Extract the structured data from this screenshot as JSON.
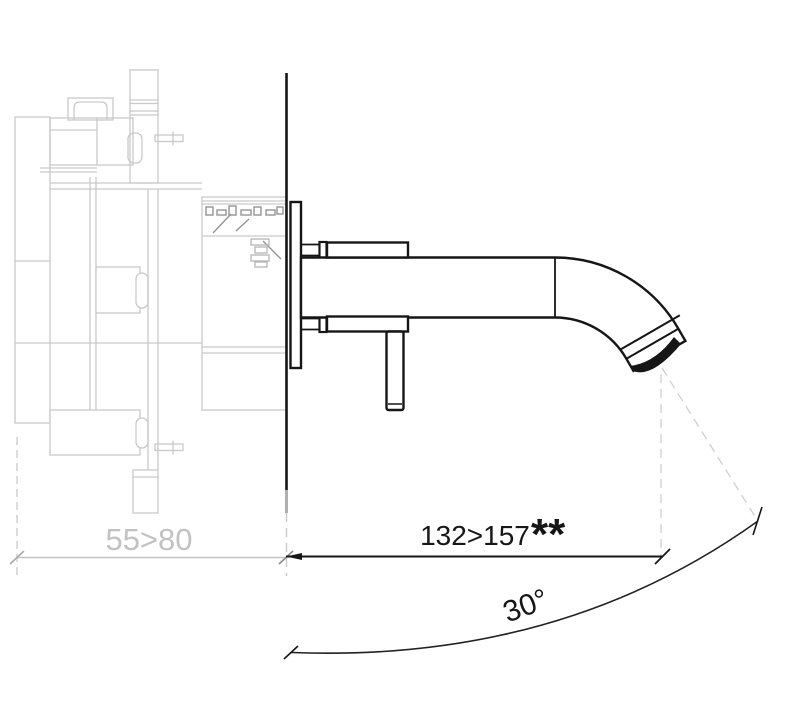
{
  "drawing": {
    "dimensions": {
      "depth_label": "55>80",
      "projection_label": "132>157",
      "projection_note": "**",
      "angle_label": "30°"
    },
    "colors": {
      "concealed_line_gray": "#c9c9c9",
      "hatch_gray": "#949494",
      "dim_text_gray": "#c2c2c2",
      "outline_black": "#161616"
    }
  }
}
